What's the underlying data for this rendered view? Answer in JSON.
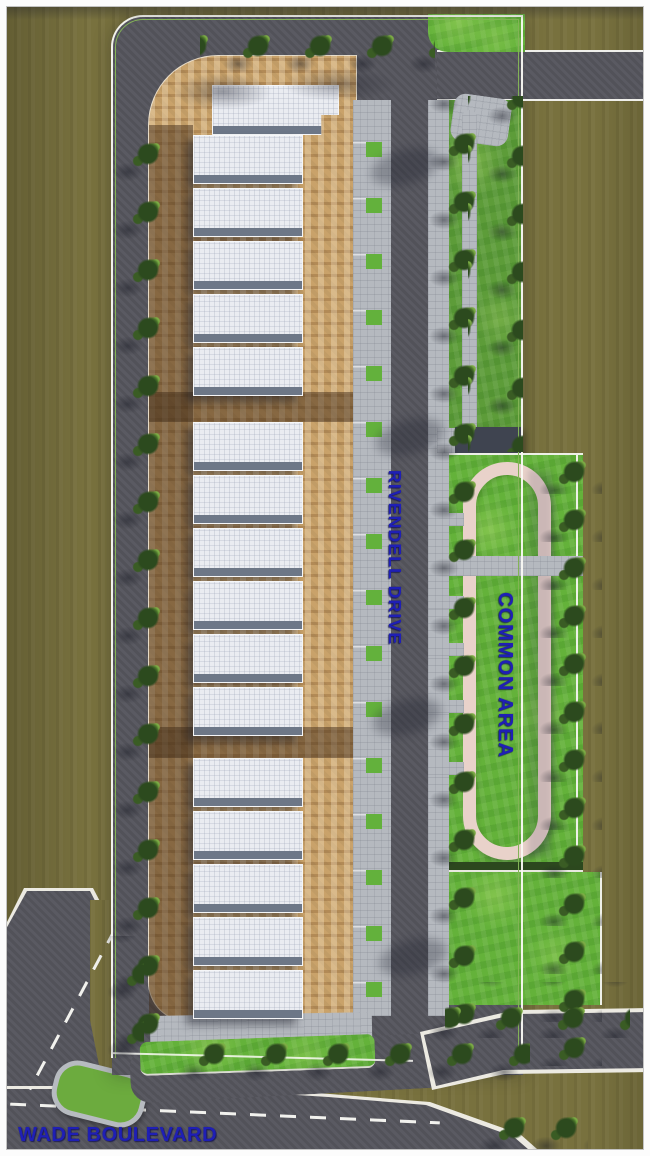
{
  "plan_labels": {
    "side_street": "RIVENDELL DRIVE",
    "bottom_street": "WADE BOULEVARD",
    "common_area": "COMMON AREA"
  },
  "building_rows": [
    {
      "name": "north building row",
      "units": 6
    },
    {
      "name": "middle building row",
      "units": 6
    },
    {
      "name": "south building row",
      "units": 5
    }
  ],
  "palette": {
    "label_blue": "#1f1fb5",
    "ground_olive": "#78713e",
    "road_gray": "#56565e",
    "brick_tan": "#c9a26a",
    "roof_white": "#eaecf1",
    "sidewalk_gray": "#b5b9bf",
    "grass_green": "#64b23a",
    "track_pink": "#e9d2ca"
  }
}
